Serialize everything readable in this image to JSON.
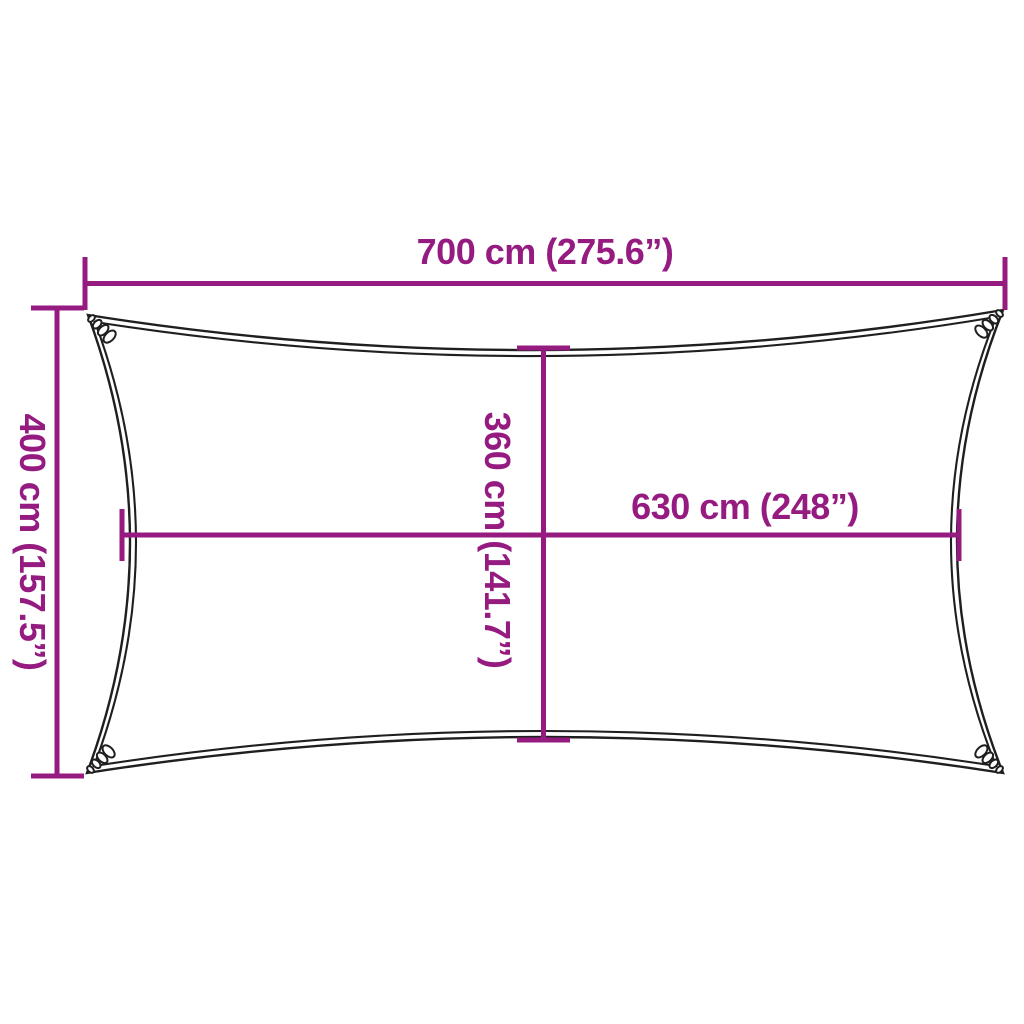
{
  "diagram": {
    "type": "product-dimension-diagram",
    "subject": "rectangular shade sail top view with concave edges and corner grommets",
    "colors": {
      "dimension_lines": "#951b81",
      "label_text": "#951b81",
      "sail_outline": "#1f1f1f",
      "background": "#ffffff"
    },
    "dimensions": {
      "top_width": {
        "label": "700 cm (275.6”)",
        "value_cm": "700",
        "value_inches": "275.6",
        "orientation": "horizontal",
        "position": "top edge, full outer width"
      },
      "left_height": {
        "label": "400 cm (157.5”)",
        "value_cm": "400",
        "value_inches": "157.5",
        "orientation": "vertical",
        "position": "left edge, full outer height"
      },
      "inner_height": {
        "label": "360 cm (141.7”)",
        "value_cm": "360",
        "value_inches": "141.7",
        "orientation": "vertical",
        "position": "center, edge-to-edge height at middle"
      },
      "inner_width": {
        "label": "630 cm (248”)",
        "value_cm": "630",
        "value_inches": "248",
        "orientation": "horizontal",
        "position": "middle, edge-to-edge width at center"
      }
    }
  }
}
